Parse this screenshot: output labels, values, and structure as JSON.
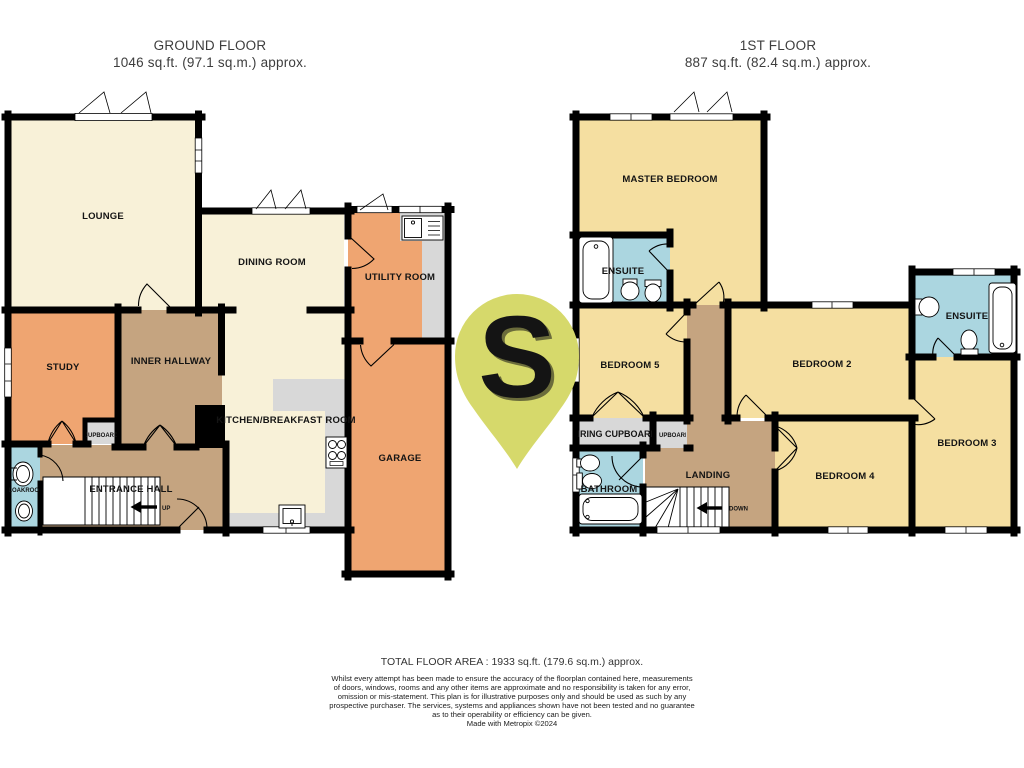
{
  "palette": {
    "wall": "#000000",
    "cream_room": "#f8f1d8",
    "yellow_room": "#f5dfa1",
    "orange_room": "#efa571",
    "tan_hall": "#c5a480",
    "blue_bathroom": "#abd6e0",
    "gray_cupboard": "#d8d8d8",
    "watermark_green": "#d6d96b",
    "title_text": "#3d3d3d",
    "footer_text": "#1c1c1c"
  },
  "ground_floor": {
    "title": "GROUND FLOOR",
    "area": "1046 sq.ft. (97.1 sq.m.) approx.",
    "rooms": {
      "lounge": "LOUNGE",
      "dining_room": "DINING ROOM",
      "utility_room": "UTILITY ROOM",
      "study": "STUDY",
      "inner_hallway": "INNER HALLWAY",
      "kitchen": "KITCHEN/BREAKFAST ROOM",
      "garage": "GARAGE",
      "entrance_hall": "ENTRANCE HALL",
      "cloakroom": "CLOAKROOM",
      "cupboard": "CUPBOARD",
      "stairs_up": "UP"
    }
  },
  "first_floor": {
    "title": "1ST FLOOR",
    "area": "887 sq.ft. (82.4 sq.m.) approx.",
    "rooms": {
      "master_bedroom": "MASTER BEDROOM",
      "ensuite_1": "ENSUITE",
      "bedroom_5": "BEDROOM 5",
      "bedroom_2": "BEDROOM 2",
      "ensuite_2": "ENSUITE",
      "bedroom_3": "BEDROOM 3",
      "bedroom_4": "BEDROOM 4",
      "landing": "LANDING",
      "airing_cupboard": "AIRING CUPBOARD",
      "cupboard": "CUPBOARD",
      "bathroom": "BATHROOM",
      "stairs_down": "DOWN"
    }
  },
  "watermark": {
    "letter": "S"
  },
  "footer": {
    "total": "TOTAL FLOOR AREA : 1933 sq.ft. (179.6 sq.m.) approx.",
    "disclaimer_lines": [
      "Whilst every attempt has been made to ensure the accuracy of the floorplan contained here, measurements",
      "of doors, windows, rooms and any other items are approximate and no responsibility is taken for any error,",
      "omission or mis-statement. This plan is for illustrative purposes only and should be used as such by any",
      "prospective purchaser. The services, systems and appliances shown have not been tested and no guarantee",
      "as to their operability or efficiency can be given."
    ],
    "credit": "Made with Metropix ©2024"
  }
}
